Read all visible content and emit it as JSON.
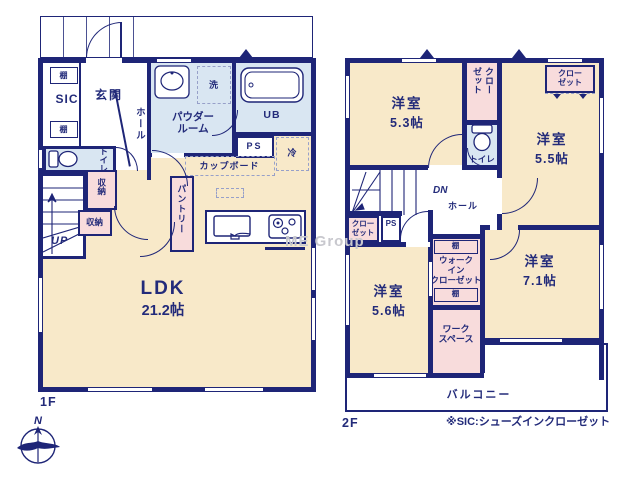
{
  "colors": {
    "wall": "#1e2577",
    "ink": "#232b7a",
    "room-cream": "#f8e9c9",
    "room-blue": "#d9e6f2",
    "room-pink": "#f8dcdc",
    "dash-line": "#97a0c9",
    "watermark": "#c8c8ce"
  },
  "labels": {
    "shelf": "棚",
    "closet": "クローゼット",
    "closet_l1": "クロー",
    "closet_l2": "ゼット",
    "toilet": "トイレ",
    "storage": "収納",
    "ps": "PS",
    "hall": "ホール",
    "western_room": "洋室"
  },
  "floor1": {
    "floor_label": "1F",
    "sic": "SIC",
    "entrance": "玄関",
    "powder_l1": "パウダー",
    "powder_l2": "ルーム",
    "laundry": "洗",
    "unit_bath": "UB",
    "fridge": "冷",
    "cupboard": "カップボード",
    "pantry": "パントリー",
    "up": "UP",
    "ldk": "LDK",
    "ldk_size": "21.2帖"
  },
  "floor2": {
    "floor_label": "2F",
    "dn": "DN",
    "room53_size": "5.3帖",
    "room55_size": "5.5帖",
    "room56_size": "5.6帖",
    "room71_size": "7.1帖",
    "wic_l1": "ウォーク",
    "wic_l2": "イン",
    "wic_l3": "クローゼット",
    "workspace_l1": "ワーク",
    "workspace_l2": "スペース",
    "balcony": "バルコニー"
  },
  "compass": {
    "north": "N"
  },
  "watermark": "ME Group",
  "footnote": "※SIC:シューズインクローゼット"
}
